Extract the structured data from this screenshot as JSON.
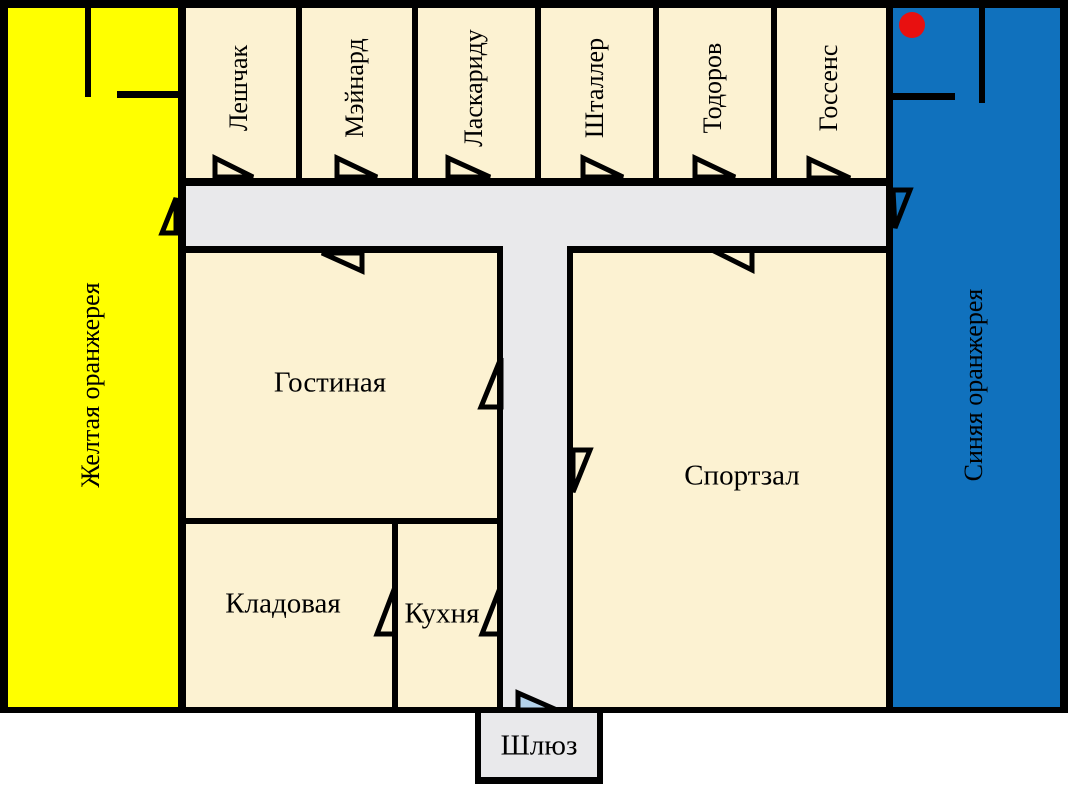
{
  "palette": {
    "yellow_greenhouse": "#ffff00",
    "blue_greenhouse": "#1071bd",
    "room_fill": "#fcf2d2",
    "corridor_fill": "#e9e9eb",
    "wall": "#000000",
    "marker_red": "#e81010",
    "airlock_door_fill": "#b4d2ea",
    "outside": "#ffffff"
  },
  "greenhouses": {
    "yellow": {
      "label": "Желтая оранжерея"
    },
    "blue": {
      "label": "Синяя оранжерея"
    }
  },
  "cabins": [
    {
      "label": "Лешчак"
    },
    {
      "label": "Мэйнард"
    },
    {
      "label": "Ласкариду"
    },
    {
      "label": "Шталлер"
    },
    {
      "label": "Тодоров"
    },
    {
      "label": "Госсенс"
    }
  ],
  "rooms": {
    "living_room": {
      "label": "Гостиная"
    },
    "gym": {
      "label": "Спортзал"
    },
    "storage": {
      "label": "Кладовая"
    },
    "kitchen": {
      "label": "Кухня"
    },
    "airlock": {
      "label": "Шлюз"
    }
  }
}
